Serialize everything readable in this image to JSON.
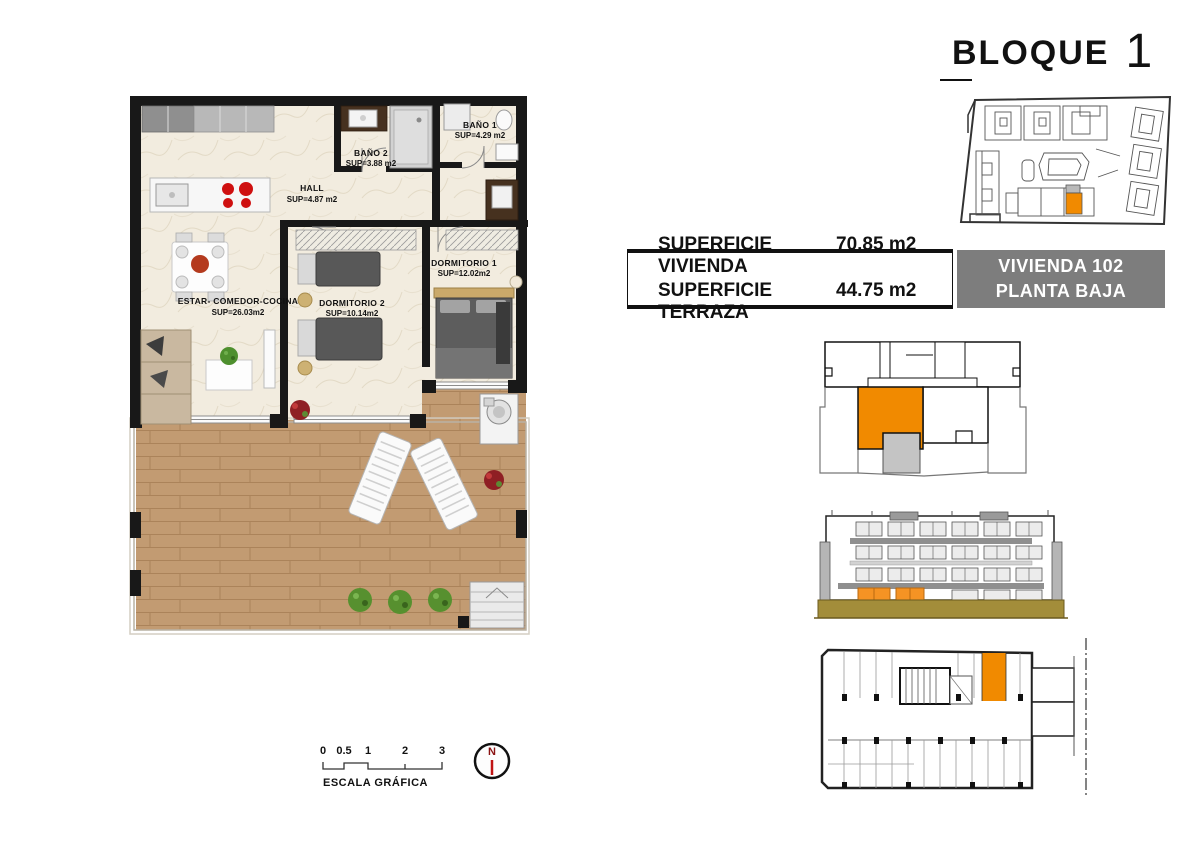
{
  "title_block": {
    "label": "BLOQUE",
    "number": "1"
  },
  "info_table": {
    "rows": [
      {
        "label": "SUPERFICIE VIVIENDA",
        "value": "70.85 m2"
      },
      {
        "label": "SUPERFICIE TERRAZA",
        "value": "44.75 m2"
      }
    ],
    "unit_box": {
      "line1": "VIVIENDA 102",
      "line2": "PLANTA BAJA"
    }
  },
  "floor_plan": {
    "rooms": [
      {
        "name": "BAÑO 2",
        "area": "SUP=3.88 m2"
      },
      {
        "name": "BAÑO 1",
        "area": "SUP=4.29 m2"
      },
      {
        "name": "HALL",
        "area": "SUP=4.87 m2"
      },
      {
        "name": "DORMITORIO 1",
        "area": "SUP=12.02m2"
      },
      {
        "name": "DORMITORIO 2",
        "area": "SUP=10.14m2"
      },
      {
        "name": "ESTAR- COMEDOR-COCINA",
        "area": "SUP=26.03m2"
      }
    ]
  },
  "scale_bar": {
    "ticks": [
      "0",
      "0.5",
      "1",
      "2",
      "3"
    ],
    "label": "ESCALA GRÁFICA"
  },
  "compass": {
    "north": "N"
  },
  "colors": {
    "highlight_orange": "#f18a00",
    "terrace_gray": "#c0c0c0",
    "unit_box_bg": "#7d7d7d",
    "base_khaki": "#a38d3a",
    "wall_black": "#181818",
    "wood": "#c29b72"
  }
}
